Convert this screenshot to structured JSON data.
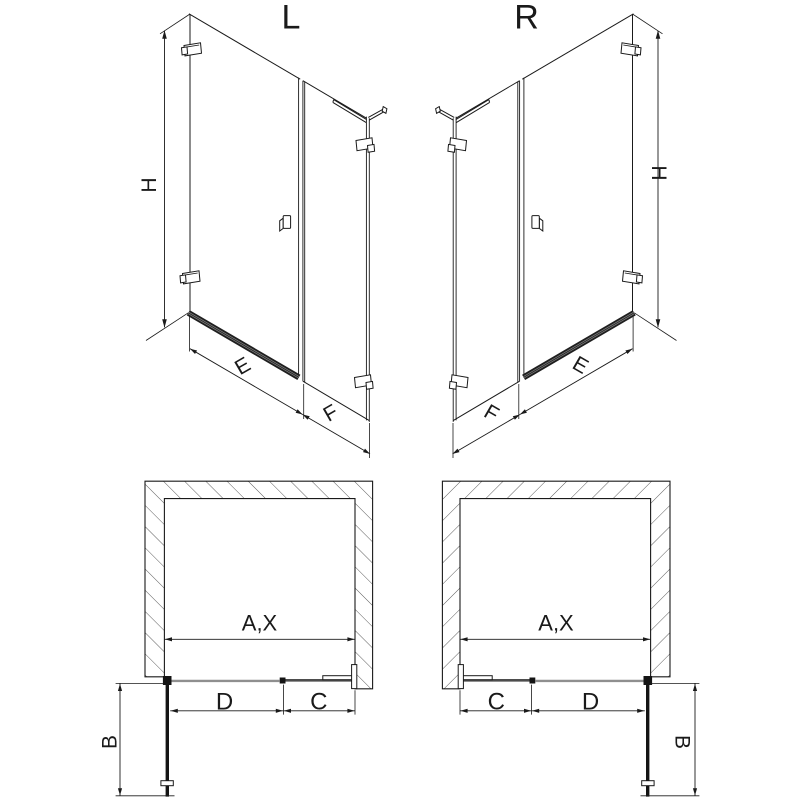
{
  "diagram": {
    "type": "shower-enclosure-technical-drawing",
    "views": {
      "perspective_left": {
        "variant_label": "L",
        "dim_height": "H",
        "dim_door_width": "E",
        "dim_side_panel_width": "F"
      },
      "perspective_right": {
        "variant_label": "R",
        "dim_height": "H",
        "dim_door_width": "E",
        "dim_side_panel_width": "F"
      },
      "plan_left": {
        "dim_opening_width": "A,X",
        "dim_door_width": "D",
        "dim_fixed_panel_width": "C",
        "dim_door_projection": "B"
      },
      "plan_right": {
        "dim_opening_width": "A,X",
        "dim_door_width": "D",
        "dim_fixed_panel_width": "C",
        "dim_door_projection": "B"
      }
    },
    "colors": {
      "line": "#1a1a1a",
      "door_glass_gray": "#8f8f8f",
      "panel_glass_dark": "#4d4d4d",
      "hatch": "#4a4a4a",
      "background": "#ffffff"
    }
  }
}
